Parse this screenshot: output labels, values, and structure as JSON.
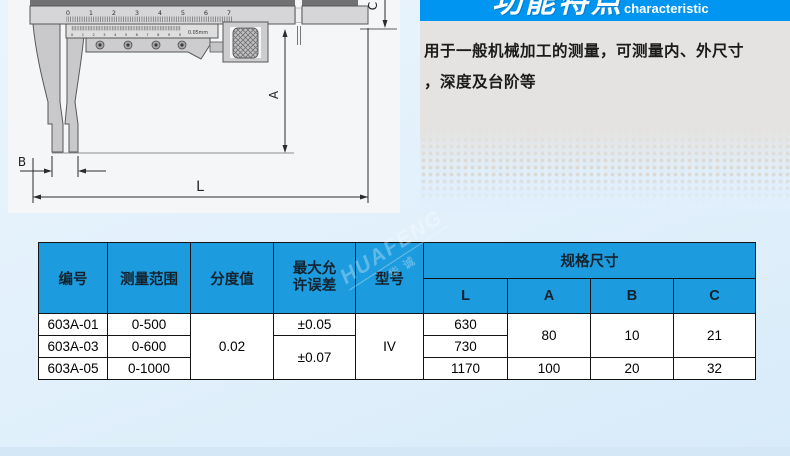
{
  "feature": {
    "title_cn": "功能特点",
    "title_en": "characteristic",
    "description_line1": "用于一般机械加工的测量，可测量内、外尺寸",
    "description_line2": "，深度及台阶等"
  },
  "diagram": {
    "scale": [
      "0",
      "1",
      "2",
      "3",
      "4",
      "5",
      "6",
      "7"
    ],
    "vernier_scale": "0 1 2 3 4 5 6 7 8 9 0",
    "vernier_unit": "0.05mm",
    "dim_a": "A",
    "dim_b": "B",
    "dim_c": "C",
    "dim_l": "L"
  },
  "watermark": {
    "latin": "HUAFENG",
    "cn": "华诚"
  },
  "table": {
    "header": {
      "part_no": "编号",
      "range": "测量范围",
      "graduation": "分度值",
      "max_error_line1": "最大允",
      "max_error_line2": "许误差",
      "model": "型号",
      "spec": "规格尺寸",
      "l": "L",
      "a": "A",
      "b": "B",
      "c": "C"
    },
    "cells": {
      "row1_no": "603A-01",
      "row1_range": "0-500",
      "row1_error": "±0.05",
      "row1_l": "630",
      "row2_no": "603A-03",
      "row2_range": "0-600",
      "row2_l": "730",
      "row3_no": "603A-05",
      "row3_range": "0-1000",
      "row3_l": "1170",
      "graduation_all": "0.02",
      "error_rows23": "±0.07",
      "model_all": "IV",
      "a_rows12": "80",
      "b_rows12": "10",
      "c_rows12": "21",
      "a_row3": "100",
      "b_row3": "20",
      "c_row3": "32"
    }
  }
}
